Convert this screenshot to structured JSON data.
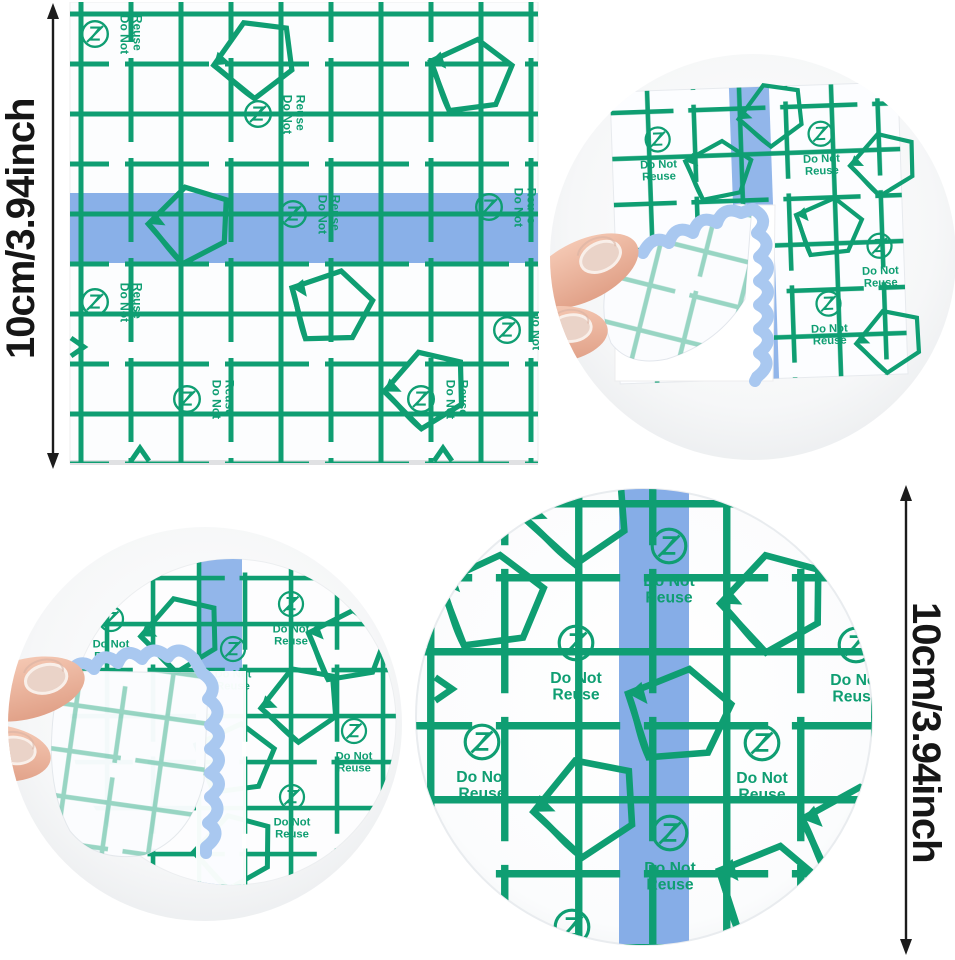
{
  "image_type": "product photo collage of transparent waterproof adhesive film dressings",
  "labels": {
    "do_not": "Do Not",
    "reuse": "Reuse"
  },
  "dimensions": {
    "left": "10cm/3.94inch",
    "right": "10cm/3.94inch"
  },
  "colors": {
    "print_green": "#0f9e72",
    "strip_blue": "#7fa9e6",
    "strip_blue_light": "#a9c8f0",
    "dimension_text": "#161616",
    "photo_circle_bg": "#eceeef",
    "film_white": "#fcfdfe",
    "skin": "#eab49e",
    "nail": "#ead3c8"
  },
  "panels": [
    {
      "id": "square-film",
      "description": "square transparent film sheet with green grid print and horizontal blue center strip, height dimension 10cm/3.94inch"
    },
    {
      "id": "peeling-square-photo",
      "description": "round photo of fingers peeling backing off a square film with vertical blue strip"
    },
    {
      "id": "peeling-round-photo",
      "description": "round photo of fingers peeling backing off a round film with vertical blue strip"
    },
    {
      "id": "round-film",
      "description": "round transparent film sheet with green grid print and vertical blue center strip, height dimension 10cm/3.94inch"
    }
  ]
}
